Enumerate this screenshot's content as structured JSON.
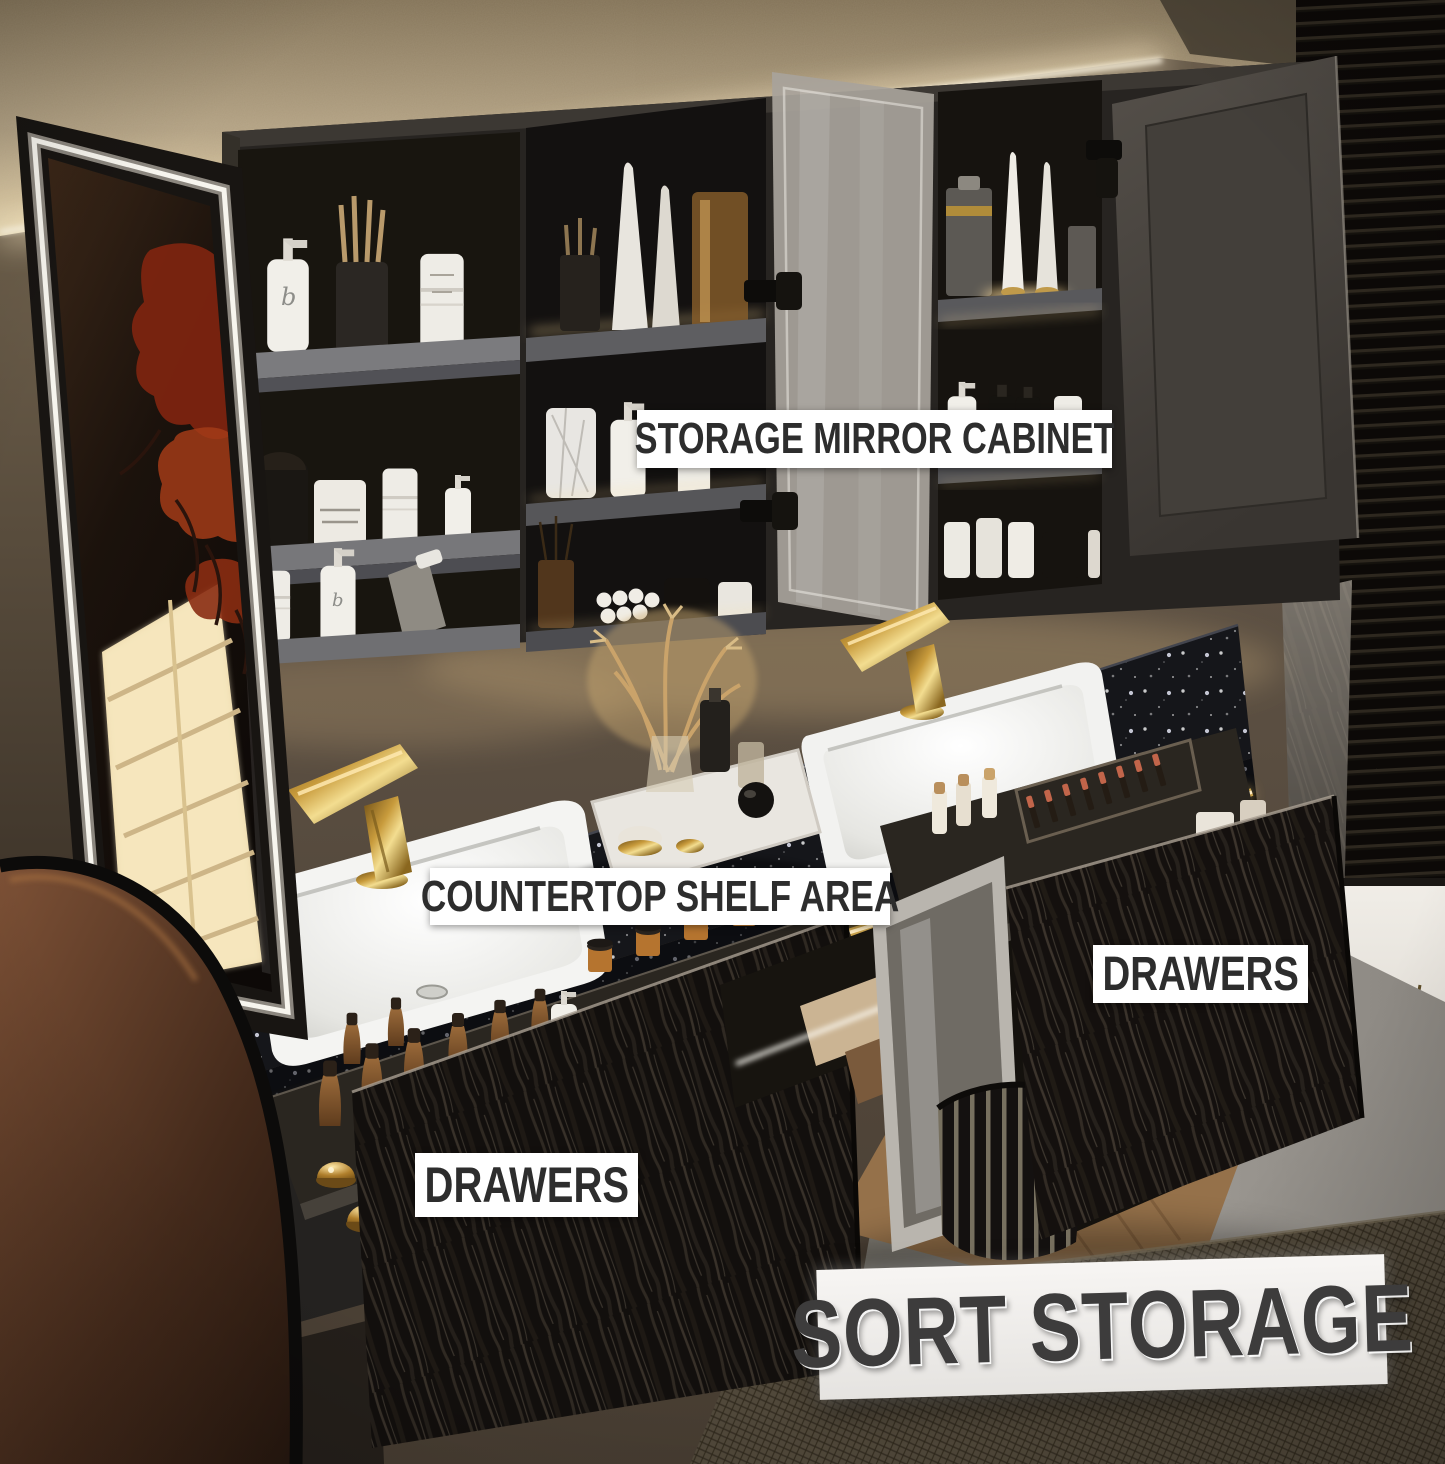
{
  "scene": {
    "type": "annotated product photo",
    "subject": "Modern bathroom double-sink floating vanity with LED mirror storage cabinet, black terrazzo countertop, gold faucets and open bark-textured storage drawers"
  },
  "annotations": {
    "storage_mirror_cabinet": "STORAGE MIRROR CABINET",
    "countertop_shelf_area": "COUNTERTOP SHELF AREA",
    "drawers_right": "DRAWERS",
    "drawers_left": "DRAWERS",
    "sort_storage": "SORT STORAGE"
  },
  "colors": {
    "label-bg": "#ffffff",
    "label-text": "#2d2d2d",
    "banner-text": "#3d3c3c",
    "gold": "#c9a24b",
    "led-warm": "#ffe9bf",
    "led-white": "#f7f5ee",
    "counter": "#14151a",
    "cabinet": "#2c2926",
    "wall": "#5a4e41",
    "ceiling": "#c3b194",
    "floor": "#908c86",
    "window": "#e9e5dd"
  }
}
